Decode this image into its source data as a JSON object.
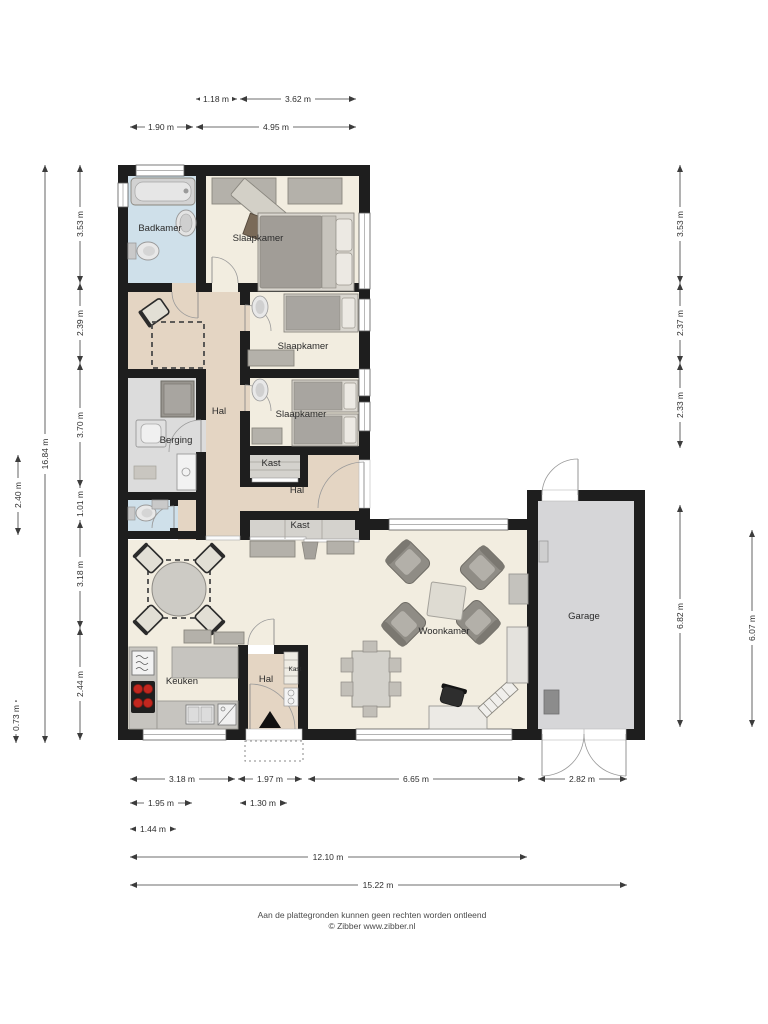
{
  "rooms": {
    "badkamer": "Badkamer",
    "slaapkamer_1": "Slaapkamer",
    "slaapkamer_2": "Slaapkamer",
    "slaapkamer_3": "Slaapkamer",
    "hal_boven": "Hal",
    "berging": "Berging",
    "kast_1": "Kast",
    "hal_achter": "Hal",
    "kast_2": "Kast",
    "keuken": "Keuken",
    "hal_entree": "Hal",
    "kast_3": "Kast",
    "woonkamer": "Woonkamer",
    "garage": "Garage"
  },
  "dims": {
    "top": [
      "1.18 m",
      "3.62 m",
      "1.90 m",
      "4.95 m"
    ],
    "left": [
      "3.53 m",
      "2.39 m",
      "3.70 m",
      "1.01 m",
      "3.18 m",
      "2.44 m",
      "16.84 m",
      "2.40 m",
      "0.73 m"
    ],
    "right": [
      "3.53 m",
      "2.37 m",
      "2.33 m",
      "6.82 m",
      "6.07 m"
    ],
    "bottom": [
      "3.18 m",
      "1.97 m",
      "6.65 m",
      "2.82 m",
      "1.95 m",
      "1.30 m",
      "1.44 m",
      "12.10 m",
      "15.22 m"
    ]
  },
  "footer": {
    "line1": "Aan de plattegronden kunnen geen rechten worden ontleend",
    "line2": "© Zibber www.zibber.nl"
  },
  "colors": {
    "wall": "#1e1e1e",
    "floor_cream": "#f2ede0",
    "floor_tan": "#e4d5c3",
    "floor_blue": "#cfe0ea",
    "floor_gray": "#dcdcdc",
    "floor_garage": "#d6d6d8",
    "burner_red": "#c2271f"
  }
}
